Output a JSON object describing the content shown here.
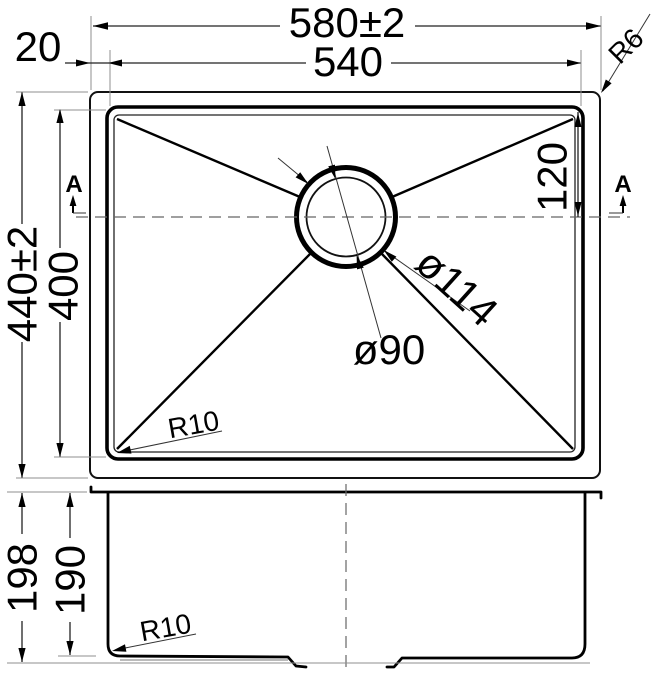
{
  "drawing": {
    "section_label": "A",
    "top_view": {
      "overall_width": "580±2",
      "inner_width": "540",
      "rim_offset": "20",
      "overall_depth": "440±2",
      "inner_depth": "400",
      "drain_offset": "120",
      "drain_outer_dia": "ø114",
      "drain_inner_dia": "ø90",
      "outer_corner_radius": "R6",
      "inner_corner_radius": "R10"
    },
    "front_view": {
      "overall_height": "198",
      "bowl_depth": "190",
      "bottom_corner_radius": "R10"
    },
    "colors": {
      "line": "#000000",
      "tolerance_dim_gray": "#8c8c8c"
    }
  }
}
